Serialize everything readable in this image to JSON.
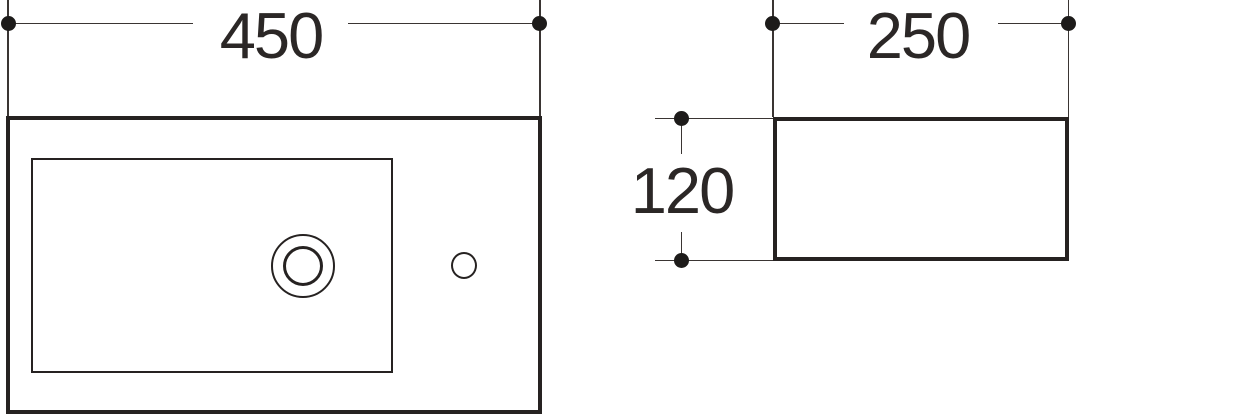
{
  "drawing": {
    "line_color": "#262221",
    "top_view": {
      "width_dimension": "450"
    },
    "side_view": {
      "depth_dimension": "250",
      "height_dimension": "120"
    }
  }
}
